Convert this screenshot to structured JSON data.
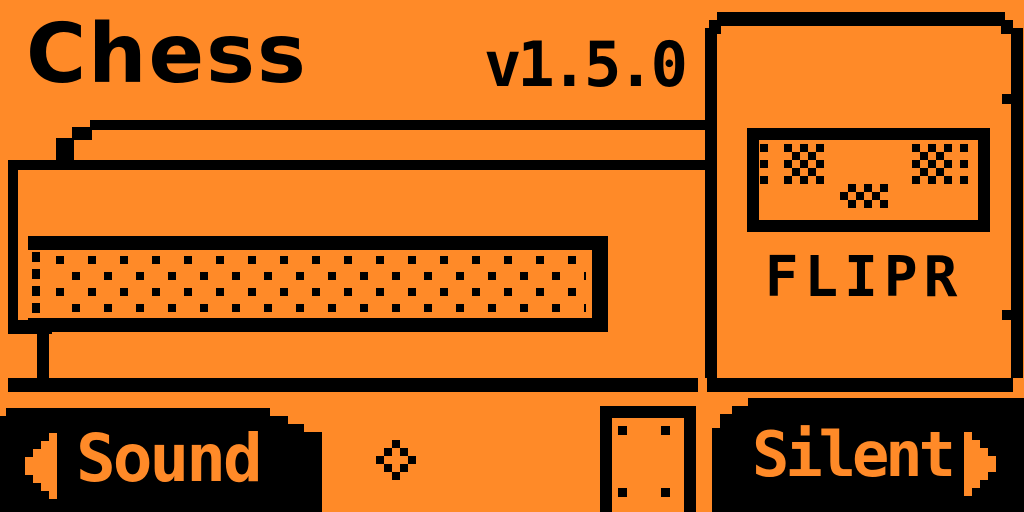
{
  "header": {
    "title": "Chess",
    "version": "v1.5.0"
  },
  "device_panel": {
    "name_label": "FLIPR",
    "screen_icon": "dithered-robot-face",
    "panel_icon": "flipper-device-outline"
  },
  "illustration": {
    "icon": "chessboard-table-side-view",
    "parts": [
      "board-top-edges",
      "dotted-board-band",
      "table-shadow-line",
      "table-leg-with-screws"
    ]
  },
  "nav_bar": {
    "left_button": {
      "label": "Sound",
      "icon": "arrow-left-icon"
    },
    "center_button": {
      "icon": "diamond-ok-icon"
    },
    "right_button": {
      "label": "Silent",
      "icon": "arrow-right-icon"
    }
  },
  "colors": {
    "background": "#FF8A28",
    "ink": "#000000"
  }
}
